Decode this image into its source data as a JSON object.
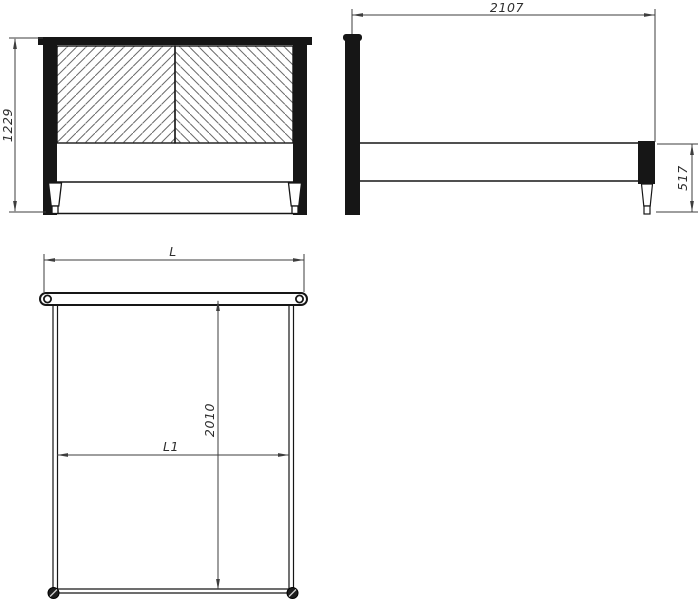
{
  "dimensions": {
    "front_height": "1229",
    "side_length": "2107",
    "side_frame_height": "517",
    "plan_width_label": "L",
    "plan_inner_length": "2010",
    "plan_inner_width_label": "L1"
  },
  "colors": {
    "background": "#ffffff",
    "object_line": "#161616",
    "dimension_line": "#3d3d3d",
    "hatch_line": "#6b6b6b",
    "text": "#2e2e2e"
  }
}
